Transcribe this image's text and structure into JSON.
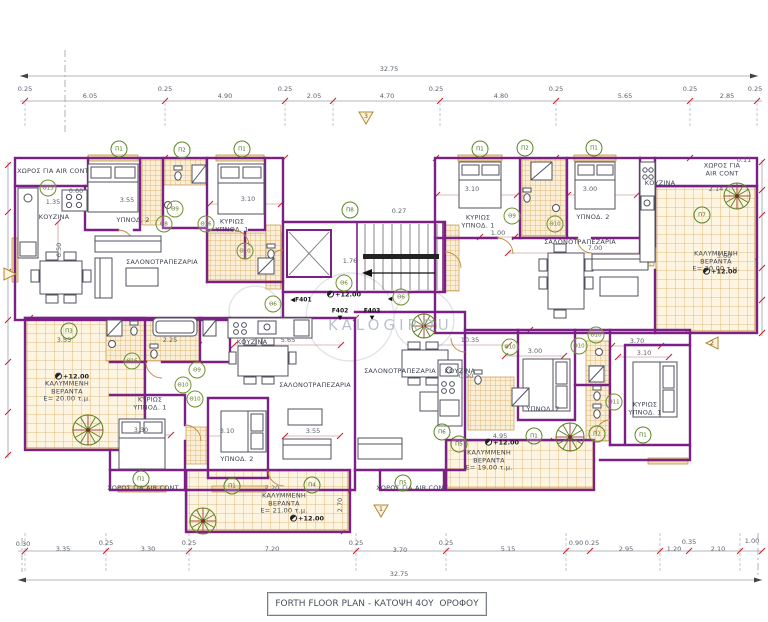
{
  "title_block": {
    "text": "FORTH FLOOR PLAN - ΚΑΤΟΨΗ 4ΟΥ  ΟΡΟΦΟΥ"
  },
  "watermark": {
    "text": "KALOGIROU"
  },
  "colors": {
    "wall": "#7b2185",
    "dimension_red": "#cc2030",
    "tile": "#d8ab5c",
    "marker_green": "#5a8422",
    "text": "#3c4250"
  },
  "annotations": {
    "dims": [
      {
        "t": "32.75",
        "x": 389,
        "y": 70
      },
      {
        "t": "6.05",
        "x": 90,
        "y": 97
      },
      {
        "t": "4.90",
        "x": 225,
        "y": 97
      },
      {
        "t": "2.05",
        "x": 314,
        "y": 97
      },
      {
        "t": "4.70",
        "x": 387,
        "y": 97
      },
      {
        "t": "4.80",
        "x": 501,
        "y": 97
      },
      {
        "t": "5.65",
        "x": 625,
        "y": 97
      },
      {
        "t": "2.85",
        "x": 727,
        "y": 97
      },
      {
        "t": "0.25",
        "x": 25,
        "y": 90
      },
      {
        "t": "0.25",
        "x": 165,
        "y": 90
      },
      {
        "t": "0.25",
        "x": 285,
        "y": 90
      },
      {
        "t": "0.25",
        "x": 436,
        "y": 90
      },
      {
        "t": "0.25",
        "x": 556,
        "y": 90
      },
      {
        "t": "0.25",
        "x": 690,
        "y": 90
      },
      {
        "t": "0.25",
        "x": 755,
        "y": 90
      },
      {
        "t": "0.30",
        "x": 23,
        "y": 545
      },
      {
        "t": "3.35",
        "x": 63,
        "y": 550
      },
      {
        "t": "0.25",
        "x": 106,
        "y": 544
      },
      {
        "t": "3.30",
        "x": 148,
        "y": 550
      },
      {
        "t": "0.25",
        "x": 189,
        "y": 544
      },
      {
        "t": "7.20",
        "x": 272,
        "y": 550
      },
      {
        "t": "0.25",
        "x": 356,
        "y": 544
      },
      {
        "t": "3.70",
        "x": 400,
        "y": 551
      },
      {
        "t": "0.25",
        "x": 446,
        "y": 544
      },
      {
        "t": "5.15",
        "x": 508,
        "y": 550
      },
      {
        "t": "0.90",
        "x": 576,
        "y": 544
      },
      {
        "t": "0.25",
        "x": 592,
        "y": 544
      },
      {
        "t": "2.95",
        "x": 626,
        "y": 550
      },
      {
        "t": "1.20",
        "x": 674,
        "y": 550
      },
      {
        "t": "0.35",
        "x": 689,
        "y": 543
      },
      {
        "t": "2.10",
        "x": 718,
        "y": 550
      },
      {
        "t": "1.00",
        "x": 752,
        "y": 542
      },
      {
        "t": "32.75",
        "x": 399,
        "y": 575
      },
      {
        "t": "3.55",
        "x": 127,
        "y": 201
      },
      {
        "t": "3.10",
        "x": 248,
        "y": 200
      },
      {
        "t": "1.35",
        "x": 53,
        "y": 203
      },
      {
        "t": "0.60",
        "x": 76,
        "y": 192
      },
      {
        "t": "6.50",
        "x": 60,
        "y": 250,
        "r": -90
      },
      {
        "t": "0.27",
        "x": 399,
        "y": 212
      },
      {
        "t": "1.76",
        "x": 350,
        "y": 262
      },
      {
        "t": "3.10",
        "x": 472,
        "y": 190
      },
      {
        "t": "3.00",
        "x": 590,
        "y": 190
      },
      {
        "t": "1.00",
        "x": 498,
        "y": 234
      },
      {
        "t": "7.00",
        "x": 595,
        "y": 249
      },
      {
        "t": "2.14",
        "x": 716,
        "y": 190
      },
      {
        "t": "3.60",
        "x": 724,
        "y": 257
      },
      {
        "t": "0.11",
        "x": 744,
        "y": 161
      },
      {
        "t": "3.55",
        "x": 64,
        "y": 341
      },
      {
        "t": "2.25",
        "x": 170,
        "y": 341
      },
      {
        "t": "5.65",
        "x": 288,
        "y": 341
      },
      {
        "t": "10.35",
        "x": 470,
        "y": 341
      },
      {
        "t": "3.00",
        "x": 535,
        "y": 352
      },
      {
        "t": "3.70",
        "x": 637,
        "y": 342
      },
      {
        "t": "3.10",
        "x": 644,
        "y": 354
      },
      {
        "t": "0.90",
        "x": 466,
        "y": 377
      },
      {
        "t": "3.30",
        "x": 141,
        "y": 431
      },
      {
        "t": "3.10",
        "x": 227,
        "y": 432
      },
      {
        "t": "3.55",
        "x": 313,
        "y": 432
      },
      {
        "t": "4.95",
        "x": 500,
        "y": 437
      },
      {
        "t": "7.20",
        "x": 272,
        "y": 489
      },
      {
        "t": "2.70",
        "x": 341,
        "y": 505,
        "r": -90
      },
      {
        "t": "+12.00",
        "x": 72,
        "y": 377,
        "c": "elev"
      },
      {
        "t": "+12.00",
        "x": 307,
        "y": 519,
        "c": "elev"
      },
      {
        "t": "+12.00",
        "x": 502,
        "y": 443,
        "c": "elev"
      },
      {
        "t": "+12.00",
        "x": 720,
        "y": 272,
        "c": "elev"
      },
      {
        "t": "+12.00",
        "x": 344,
        "y": 295,
        "c": "elev"
      }
    ],
    "rooms": [
      {
        "t": "ΧΩΡΟΣ ΓΙΑ AIR CONT",
        "x": 53,
        "y": 172
      },
      {
        "t": "ΚΟΥΖΙΝΑ",
        "x": 54,
        "y": 218
      },
      {
        "t": "ΥΠΝΟΔ. 2",
        "x": 133,
        "y": 221
      },
      {
        "t": "ΚΥΡΙΩΣ\nΥΠΝΟΔ. 1",
        "x": 232,
        "y": 226
      },
      {
        "t": "ΣΑΛΟΝΟΤΡΑΠΕΖΑΡΙΑ",
        "x": 162,
        "y": 263
      },
      {
        "t": "ΚΥΡΙΩΣ\nΥΠΝΟΔ. 1",
        "x": 478,
        "y": 222
      },
      {
        "t": "ΥΠΝΟΔ. 2",
        "x": 593,
        "y": 218
      },
      {
        "t": "ΣΑΛΟΝΟΤΡΑΠΕΖΑΡΙΑ",
        "x": 580,
        "y": 243
      },
      {
        "t": "ΚΟΥΖΙΝΑ",
        "x": 660,
        "y": 184
      },
      {
        "t": "ΧΩΡΟΣ ΓΙΑ AIR CONT",
        "x": 722,
        "y": 170
      },
      {
        "t": "ΚΑΛΥΜΜΕΝΗ\nΒΕΡΑΝΤΑ\nΕ= 20.00 τ.μ.",
        "x": 716,
        "y": 262
      },
      {
        "t": "ΚΑΛΥΜΜΕΝΗ\nΒΕΡΑΝΤΑ\nΕ= 20.00 τ.μ.",
        "x": 67,
        "y": 392
      },
      {
        "t": "ΚΥΡΙΩΣ\nΥΠΝΟΔ. 1",
        "x": 150,
        "y": 404
      },
      {
        "t": "ΚΟΥΖΙΝΑ",
        "x": 252,
        "y": 343
      },
      {
        "t": "ΣΑΛΟΝΟΤΡΑΠΕΖΑΡΙΑ",
        "x": 315,
        "y": 386
      },
      {
        "t": "ΥΠΝΟΔ. 2",
        "x": 237,
        "y": 460
      },
      {
        "t": "ΚΑΛΥΜΜΕΝΗ\nΒΕΡΑΝΤΑ\nΕ= 21.00 τ.μ.",
        "x": 284,
        "y": 504
      },
      {
        "t": "ΧΩΡΟΣ ΓΙΑ AIR.CONT",
        "x": 143,
        "y": 489
      },
      {
        "t": "ΣΑΛΟΝΟΤΡΑΠΕΖΑΡΙΑ",
        "x": 400,
        "y": 372
      },
      {
        "t": "ΚΟΥΖΙΝΑ",
        "x": 460,
        "y": 372
      },
      {
        "t": "ΥΠΝΟΔ. 2",
        "x": 543,
        "y": 410
      },
      {
        "t": "ΚΑΛΥΜΜΕΝΗ\nΒΕΡΑΝΤΑ\nΕ= 19.00 τ.μ.",
        "x": 489,
        "y": 461
      },
      {
        "t": "ΚΥΡΙΩΣ\nΥΠΝΟΔ. 1",
        "x": 645,
        "y": 409
      },
      {
        "t": "ΧΩΡΟΣ ΓΙΑ AIR.CONT",
        "x": 412,
        "y": 489
      }
    ],
    "markers": [
      {
        "t": "Π1",
        "x": 119,
        "y": 149
      },
      {
        "t": "Π2",
        "x": 182,
        "y": 150
      },
      {
        "t": "Π1",
        "x": 242,
        "y": 149
      },
      {
        "t": "Π8",
        "x": 350,
        "y": 210
      },
      {
        "t": "Π1",
        "x": 480,
        "y": 149
      },
      {
        "t": "Π2",
        "x": 525,
        "y": 148
      },
      {
        "t": "Π1",
        "x": 594,
        "y": 148
      },
      {
        "t": "Π7",
        "x": 702,
        "y": 215
      },
      {
        "t": "Π3",
        "x": 69,
        "y": 331
      },
      {
        "t": "Π1",
        "x": 141,
        "y": 479
      },
      {
        "t": "Π1",
        "x": 232,
        "y": 486
      },
      {
        "t": "Π4",
        "x": 312,
        "y": 485
      },
      {
        "t": "Π5",
        "x": 403,
        "y": 483
      },
      {
        "t": "Π6",
        "x": 442,
        "y": 432
      },
      {
        "t": "Π5",
        "x": 459,
        "y": 444
      },
      {
        "t": "Π1",
        "x": 534,
        "y": 436
      },
      {
        "t": "Π2",
        "x": 597,
        "y": 434
      },
      {
        "t": "Π1",
        "x": 643,
        "y": 435
      },
      {
        "t": "Θ13",
        "x": 48,
        "y": 188,
        "k": "th"
      },
      {
        "t": "Θ9",
        "x": 175,
        "y": 209,
        "k": "th"
      },
      {
        "t": "Θ8",
        "x": 164,
        "y": 224,
        "k": "th"
      },
      {
        "t": "Θ16",
        "x": 206,
        "y": 224,
        "k": "th"
      },
      {
        "t": "Θ10",
        "x": 245,
        "y": 251,
        "k": "th"
      },
      {
        "t": "Θ6",
        "x": 273,
        "y": 304,
        "k": "th"
      },
      {
        "t": "Θ6",
        "x": 344,
        "y": 283,
        "k": "th"
      },
      {
        "t": "Θ6",
        "x": 401,
        "y": 297,
        "k": "th"
      },
      {
        "t": "Θ9",
        "x": 512,
        "y": 216,
        "k": "th"
      },
      {
        "t": "Θ10",
        "x": 555,
        "y": 224,
        "k": "th"
      },
      {
        "t": "Θ16",
        "x": 132,
        "y": 361,
        "k": "th"
      },
      {
        "t": "Θ9",
        "x": 197,
        "y": 370,
        "k": "th"
      },
      {
        "t": "Θ10",
        "x": 183,
        "y": 385,
        "k": "th"
      },
      {
        "t": "Θ10",
        "x": 195,
        "y": 399,
        "k": "th"
      },
      {
        "t": "Θ10",
        "x": 510,
        "y": 347,
        "k": "th"
      },
      {
        "t": "Θ10",
        "x": 579,
        "y": 346,
        "k": "th"
      },
      {
        "t": "Θ10",
        "x": 596,
        "y": 335,
        "k": "th"
      },
      {
        "t": "Θ11",
        "x": 614,
        "y": 402,
        "k": "th"
      }
    ],
    "flags": [
      {
        "t": "◀F401",
        "x": 301,
        "y": 300
      },
      {
        "t": "F402",
        "x": 340,
        "y": 311
      },
      {
        "t": "F403",
        "x": 372,
        "y": 311
      },
      {
        "t": "▼",
        "x": 340,
        "y": 318
      },
      {
        "t": "▼",
        "x": 372,
        "y": 318
      },
      {
        "t": "◀",
        "x": 390,
        "y": 299
      }
    ],
    "triangles": [
      {
        "t": "3",
        "x": 366,
        "y": 120,
        "d": "down"
      },
      {
        "t": "2",
        "x": 712,
        "y": 345,
        "d": "left"
      },
      {
        "t": "1",
        "x": 381,
        "y": 513,
        "d": "down"
      },
      {
        "t": "",
        "x": 10,
        "y": 276,
        "d": "right"
      }
    ]
  }
}
